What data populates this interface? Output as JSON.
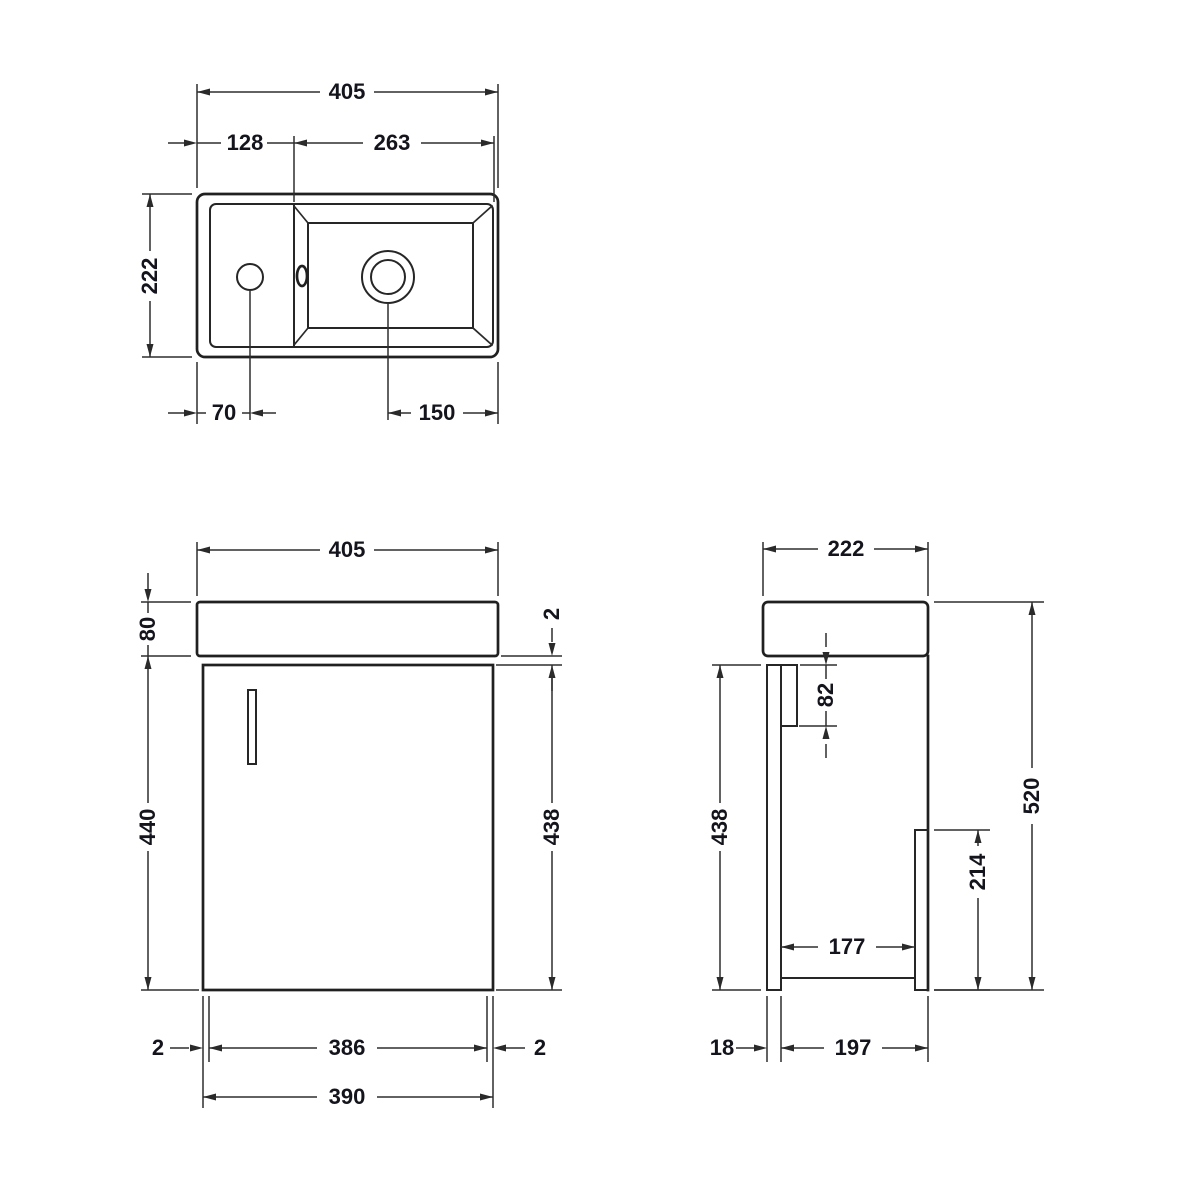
{
  "page": {
    "background": "#ffffff",
    "line_color": "#262626",
    "text_color": "#14141d",
    "description": "Technical dimension drawing of wall-hung cloakroom vanity basin unit: plan view, front elevation and side elevation"
  },
  "plan_view": {
    "overall_width": "405",
    "left_section_width": "128",
    "bowl_width": "263",
    "overall_depth": "222",
    "tap_hole_centre": "70",
    "waste_centre": "150"
  },
  "front_view": {
    "overall_width": "405",
    "basin_height": "80",
    "basin_overhang": "2",
    "cabinet_height": "440",
    "door_height": "438",
    "left_panel_thickness": "2",
    "internal_width": "386",
    "right_panel_thickness": "2",
    "carcass_width": "390"
  },
  "side_view": {
    "overall_depth": "222",
    "hanger_rail_height": "82",
    "cabinet_height": "438",
    "overall_height": "520",
    "service_recess_height": "214",
    "internal_depth": "177",
    "door_thickness": "18",
    "carcass_depth": "197"
  }
}
